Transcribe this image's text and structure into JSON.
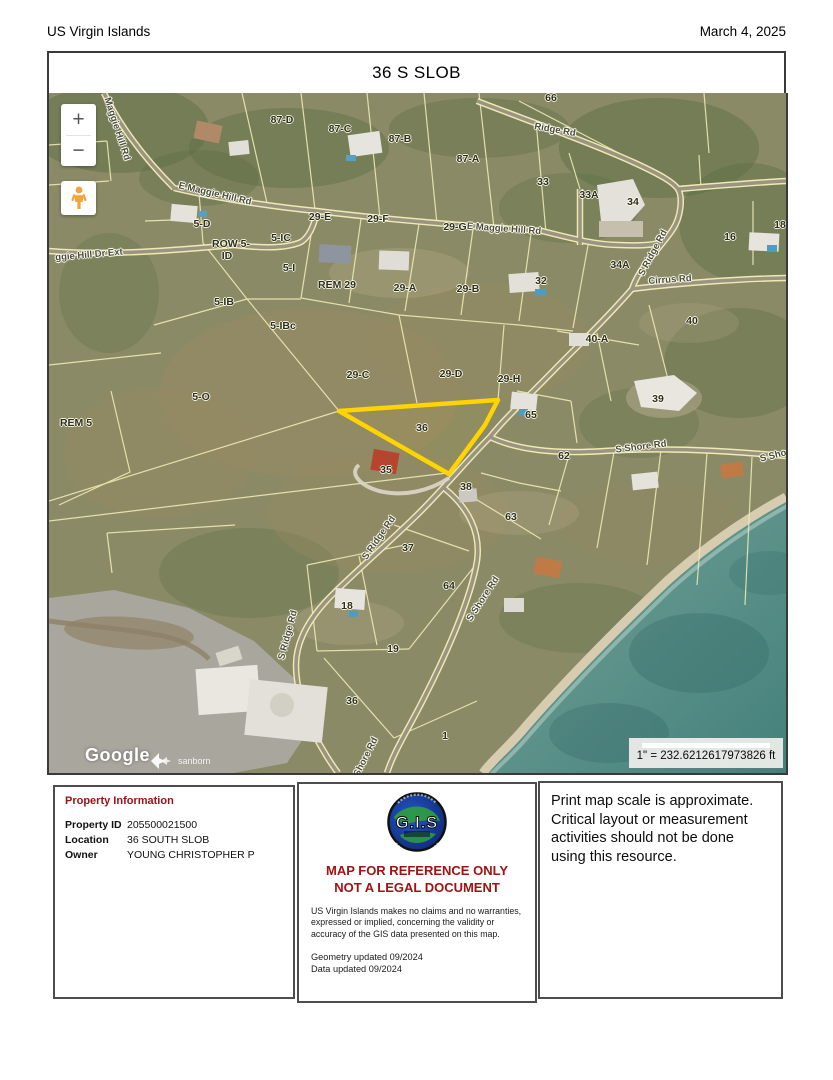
{
  "header": {
    "region": "US Virgin Islands",
    "date": "March 4, 2025"
  },
  "title": "36 S SLOB",
  "map": {
    "controls": {
      "zoom_in": "+",
      "zoom_out": "−"
    },
    "scale_text": "1\" = 232.6212617973826 ft",
    "attribution": {
      "google": "Google",
      "sanborn": "sanborn"
    },
    "highlighted_parcel": "36",
    "road_labels": [
      {
        "text": "Maggie Hill Rd",
        "x": 68,
        "y": 36,
        "rot": 72
      },
      {
        "text": "E Maggie Hill Rd",
        "x": 166,
        "y": 101,
        "rot": 13
      },
      {
        "text": "Ridge Rd",
        "x": 506,
        "y": 37,
        "rot": 10
      },
      {
        "text": "E Maggie Hill Rd",
        "x": 455,
        "y": 136,
        "rot": 4
      },
      {
        "text": "S Ridge Rd",
        "x": 604,
        "y": 160,
        "rot": -62
      },
      {
        "text": "Cirrus Rd",
        "x": 621,
        "y": 187,
        "rot": -4
      },
      {
        "text": "S Shore Rd",
        "x": 592,
        "y": 354,
        "rot": -7
      },
      {
        "text": "S Shore Rd",
        "x": 736,
        "y": 360,
        "rot": -14
      },
      {
        "text": "S Ridge Rd",
        "x": 330,
        "y": 445,
        "rot": -55
      },
      {
        "text": "S Ridge Rd",
        "x": 239,
        "y": 542,
        "rot": -75
      },
      {
        "text": "S Shore Rd",
        "x": 434,
        "y": 506,
        "rot": -57
      },
      {
        "text": "Shore Rd",
        "x": 317,
        "y": 664,
        "rot": -63
      },
      {
        "text": "ggie Hill Dr Ext",
        "x": 40,
        "y": 162,
        "rot": -5
      }
    ],
    "parcel_labels": [
      {
        "text": "87-D",
        "x": 233,
        "y": 27
      },
      {
        "text": "87-C",
        "x": 291,
        "y": 36
      },
      {
        "text": "87-B",
        "x": 351,
        "y": 46
      },
      {
        "text": "87-A",
        "x": 419,
        "y": 66
      },
      {
        "text": "66",
        "x": 502,
        "y": 5
      },
      {
        "text": "33",
        "x": 494,
        "y": 89
      },
      {
        "text": "33A",
        "x": 540,
        "y": 102
      },
      {
        "text": "34",
        "x": 584,
        "y": 109
      },
      {
        "text": "34A",
        "x": 571,
        "y": 172
      },
      {
        "text": "16",
        "x": 681,
        "y": 144
      },
      {
        "text": "18",
        "x": 731,
        "y": 132
      },
      {
        "text": "29-E",
        "x": 271,
        "y": 124
      },
      {
        "text": "29-F",
        "x": 329,
        "y": 126
      },
      {
        "text": "29-G",
        "x": 406,
        "y": 134
      },
      {
        "text": "5-D",
        "x": 153,
        "y": 131
      },
      {
        "text": "5-IC",
        "x": 232,
        "y": 145
      },
      {
        "text": "ROW 5-",
        "x": 182,
        "y": 151
      },
      {
        "text": "ID",
        "x": 178,
        "y": 163
      },
      {
        "text": "5-I",
        "x": 240,
        "y": 175
      },
      {
        "text": "REM 29",
        "x": 288,
        "y": 192
      },
      {
        "text": "29-A",
        "x": 356,
        "y": 195
      },
      {
        "text": "29-B",
        "x": 419,
        "y": 196
      },
      {
        "text": "32",
        "x": 492,
        "y": 188
      },
      {
        "text": "40",
        "x": 643,
        "y": 228
      },
      {
        "text": "40-A",
        "x": 548,
        "y": 246
      },
      {
        "text": "5-IB",
        "x": 175,
        "y": 209
      },
      {
        "text": "5-IBc",
        "x": 234,
        "y": 233
      },
      {
        "text": "29-C",
        "x": 309,
        "y": 282
      },
      {
        "text": "29-D",
        "x": 402,
        "y": 281
      },
      {
        "text": "29-H",
        "x": 460,
        "y": 286
      },
      {
        "text": "5-O",
        "x": 152,
        "y": 304
      },
      {
        "text": "REM 5",
        "x": 27,
        "y": 330
      },
      {
        "text": "36",
        "x": 373,
        "y": 335
      },
      {
        "text": "65",
        "x": 482,
        "y": 322
      },
      {
        "text": "35",
        "x": 337,
        "y": 377
      },
      {
        "text": "38",
        "x": 417,
        "y": 394
      },
      {
        "text": "62",
        "x": 515,
        "y": 363
      },
      {
        "text": "39",
        "x": 609,
        "y": 306
      },
      {
        "text": "63",
        "x": 462,
        "y": 424
      },
      {
        "text": "37",
        "x": 359,
        "y": 455
      },
      {
        "text": "64",
        "x": 400,
        "y": 493
      },
      {
        "text": "18",
        "x": 298,
        "y": 513
      },
      {
        "text": "19",
        "x": 344,
        "y": 556
      },
      {
        "text": "36",
        "x": 303,
        "y": 608
      },
      {
        "text": "1",
        "x": 396,
        "y": 643
      }
    ]
  },
  "footer": {
    "property_info": {
      "heading": "Property Information",
      "rows": [
        {
          "label": "Property ID",
          "value": "205500021500"
        },
        {
          "label": "Location",
          "value": "36 SOUTH SLOB"
        },
        {
          "label": "Owner",
          "value": "YOUNG CHRISTOPHER P"
        }
      ]
    },
    "reference": {
      "logo_text": "G.I.S",
      "warning_line1": "MAP FOR REFERENCE ONLY",
      "warning_line2": "NOT A LEGAL DOCUMENT",
      "disclaimer": "US Virgin Islands makes no claims and no warranties, expressed or implied, concerning the validity or accuracy of the GIS data presented on this map.",
      "geometry_updated": "Geometry updated 09/2024",
      "data_updated": "Data updated 09/2024"
    },
    "scale_note": "Print map scale is approximate. Critical layout or measurement activities should not be done using this resource."
  },
  "colors": {
    "highlight_yellow": "#FFD400",
    "warning_red": "#9B1212",
    "parcel_line_yellow": "#EFE9B4",
    "ocean_teal": "#5F948C"
  }
}
